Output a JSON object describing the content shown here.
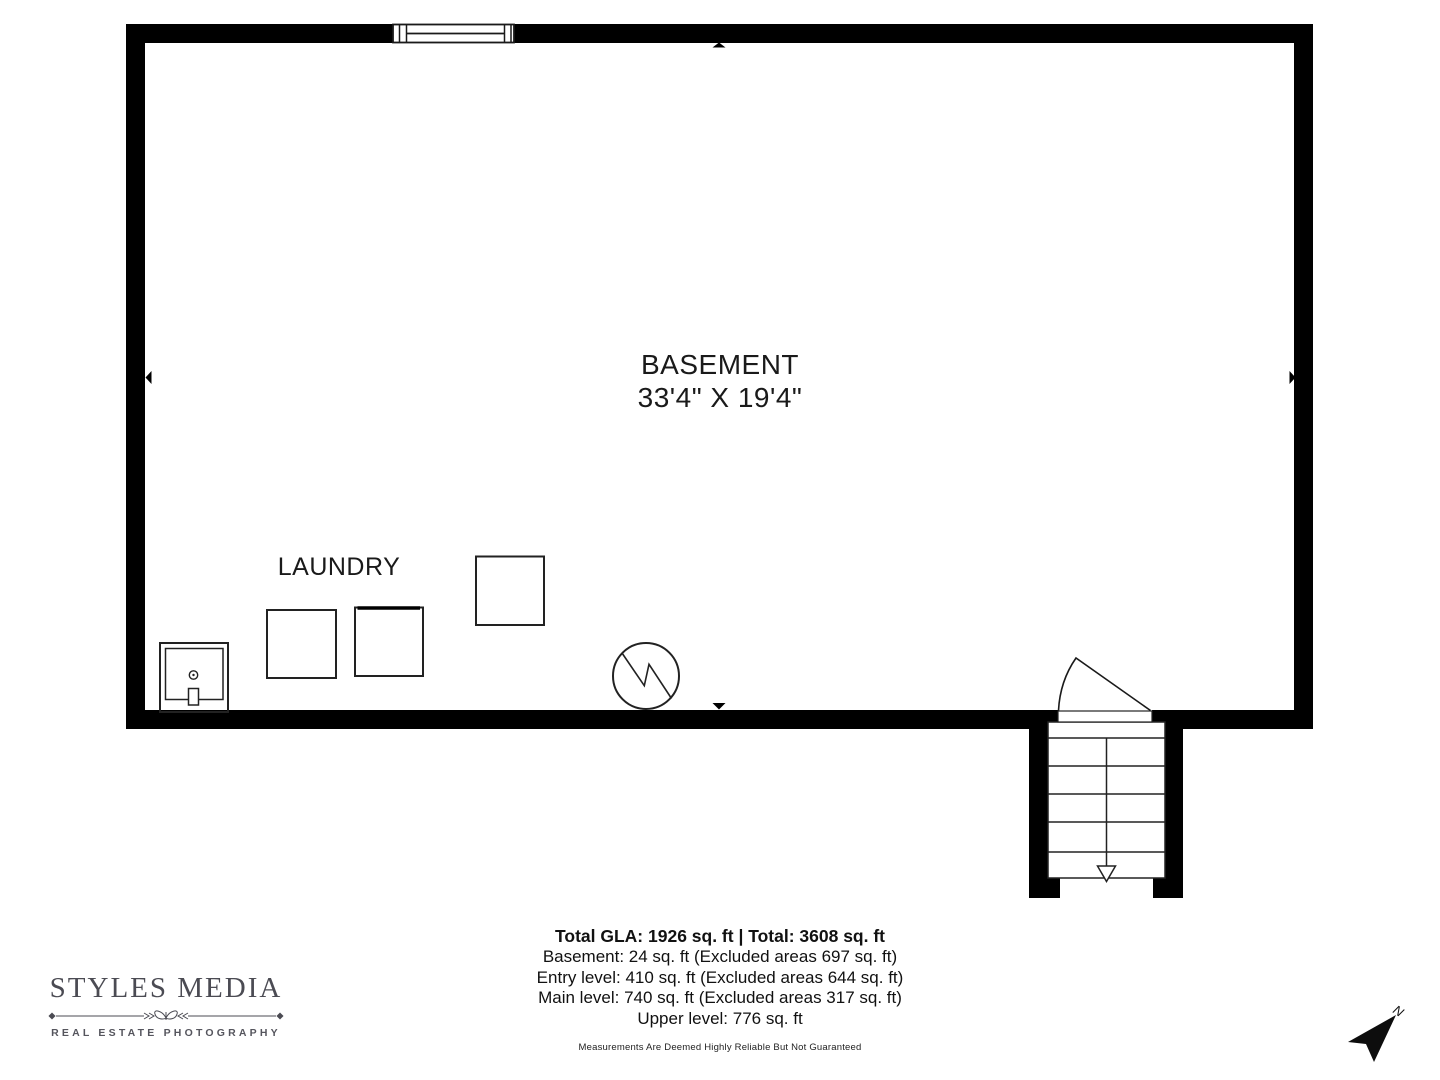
{
  "floor_plan": {
    "room_name": "BASEMENT",
    "room_dims": "33'4\" X 19'4\"",
    "laundry_label": "LAUNDRY"
  },
  "summary": {
    "total_line": "Total GLA: 1926 sq. ft | Total: 3608 sq. ft",
    "lines": [
      "Basement: 24 sq. ft (Excluded areas 697 sq. ft)",
      "Entry level: 410 sq. ft (Excluded areas 644 sq. ft)",
      "Main level: 740 sq. ft (Excluded areas 317 sq. ft)",
      "Upper level: 776 sq. ft"
    ],
    "disclaimer": "Measurements Are Deemed Highly Reliable But Not Guaranteed"
  },
  "branding": {
    "name": "STYLES MEDIA",
    "tagline": "REAL ESTATE PHOTOGRAPHY"
  },
  "compass": {
    "label": "N"
  },
  "colors": {
    "wall": "#000000",
    "line": "#222222",
    "text": "#1a1a1a",
    "logo": "#4b4b53"
  }
}
